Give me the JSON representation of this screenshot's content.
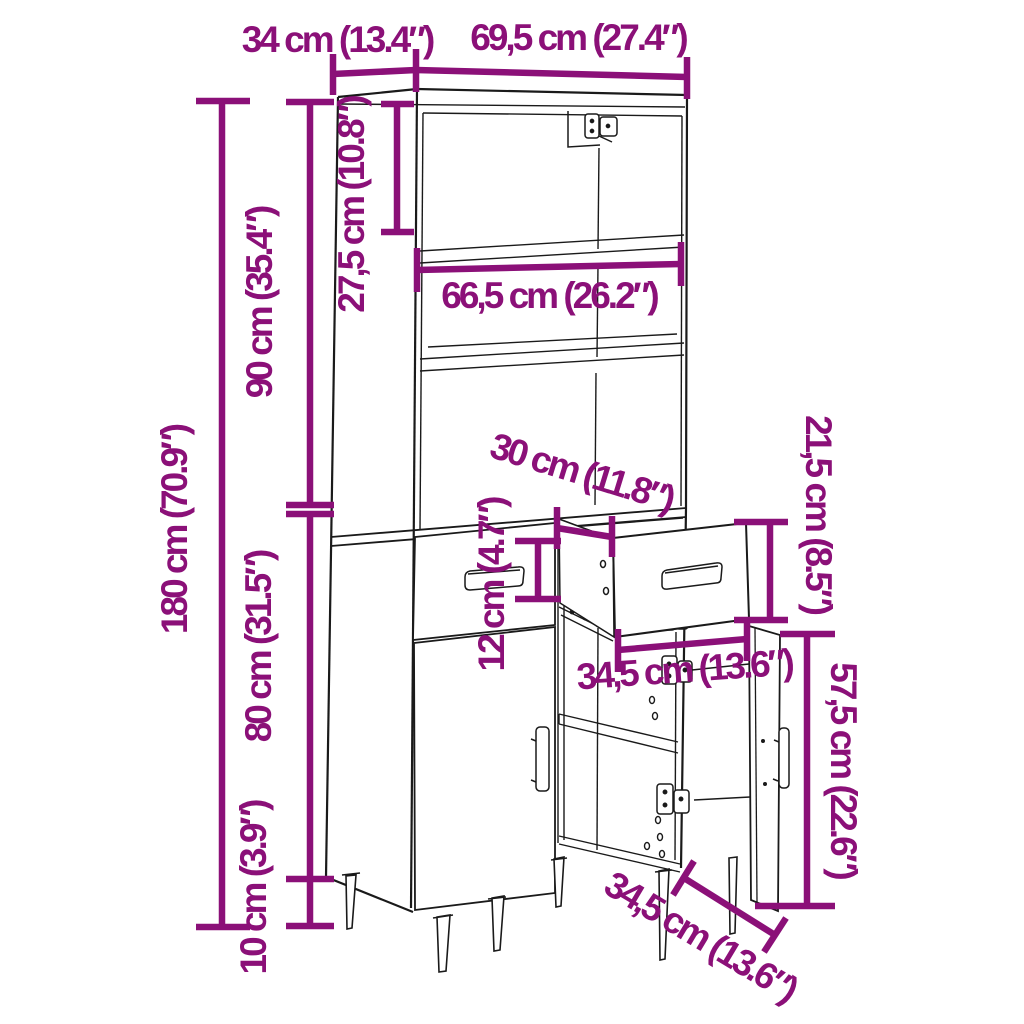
{
  "diagram": {
    "type": "furniture-dimension-drawing",
    "product": "highboard-cabinet",
    "units": [
      "cm",
      "inches"
    ],
    "colors": {
      "dimension_accent": "#8B1078",
      "line_art": "#1A1A1A",
      "background": "#FFFFFF"
    },
    "dimensions": [
      {
        "name": "depth",
        "label": "34 cm (13.4″)",
        "cm": "34",
        "inches": "13.4"
      },
      {
        "name": "width",
        "label": "69,5 cm (27.4″)",
        "cm": "69,5",
        "inches": "27.4"
      },
      {
        "name": "top-compartment-height",
        "label": "27,5 cm (10.8″)",
        "cm": "27,5",
        "inches": "10.8"
      },
      {
        "name": "interior-width",
        "label": "66,5 cm (26.2″)",
        "cm": "66,5",
        "inches": "26.2"
      },
      {
        "name": "total-height",
        "label": "180 cm (70.9″)",
        "cm": "180",
        "inches": "70.9"
      },
      {
        "name": "upper-section-height",
        "label": "90 cm (35.4″)",
        "cm": "90",
        "inches": "35.4"
      },
      {
        "name": "lower-section-height",
        "label": "80 cm (31.5″)",
        "cm": "80",
        "inches": "31.5"
      },
      {
        "name": "leg-height",
        "label": "10 cm (3.9″)",
        "cm": "10",
        "inches": "3.9"
      },
      {
        "name": "drawer-depth",
        "label": "30 cm (11.8″)",
        "cm": "30",
        "inches": "11.8"
      },
      {
        "name": "drawer-box-height",
        "label": "12 cm (4.7″)",
        "cm": "12",
        "inches": "4.7"
      },
      {
        "name": "drawer-front-height",
        "label": "21,5 cm (8.5″)",
        "cm": "21,5",
        "inches": "8.5"
      },
      {
        "name": "drawer-width",
        "label": "34,5 cm (13.6″)",
        "cm": "34,5",
        "inches": "13.6"
      },
      {
        "name": "door-height",
        "label": "57,5 cm (22.6″)",
        "cm": "57,5",
        "inches": "22.6"
      },
      {
        "name": "door-width",
        "label": "34,5 cm (13.6″)",
        "cm": "34,5",
        "inches": "13.6"
      }
    ]
  }
}
